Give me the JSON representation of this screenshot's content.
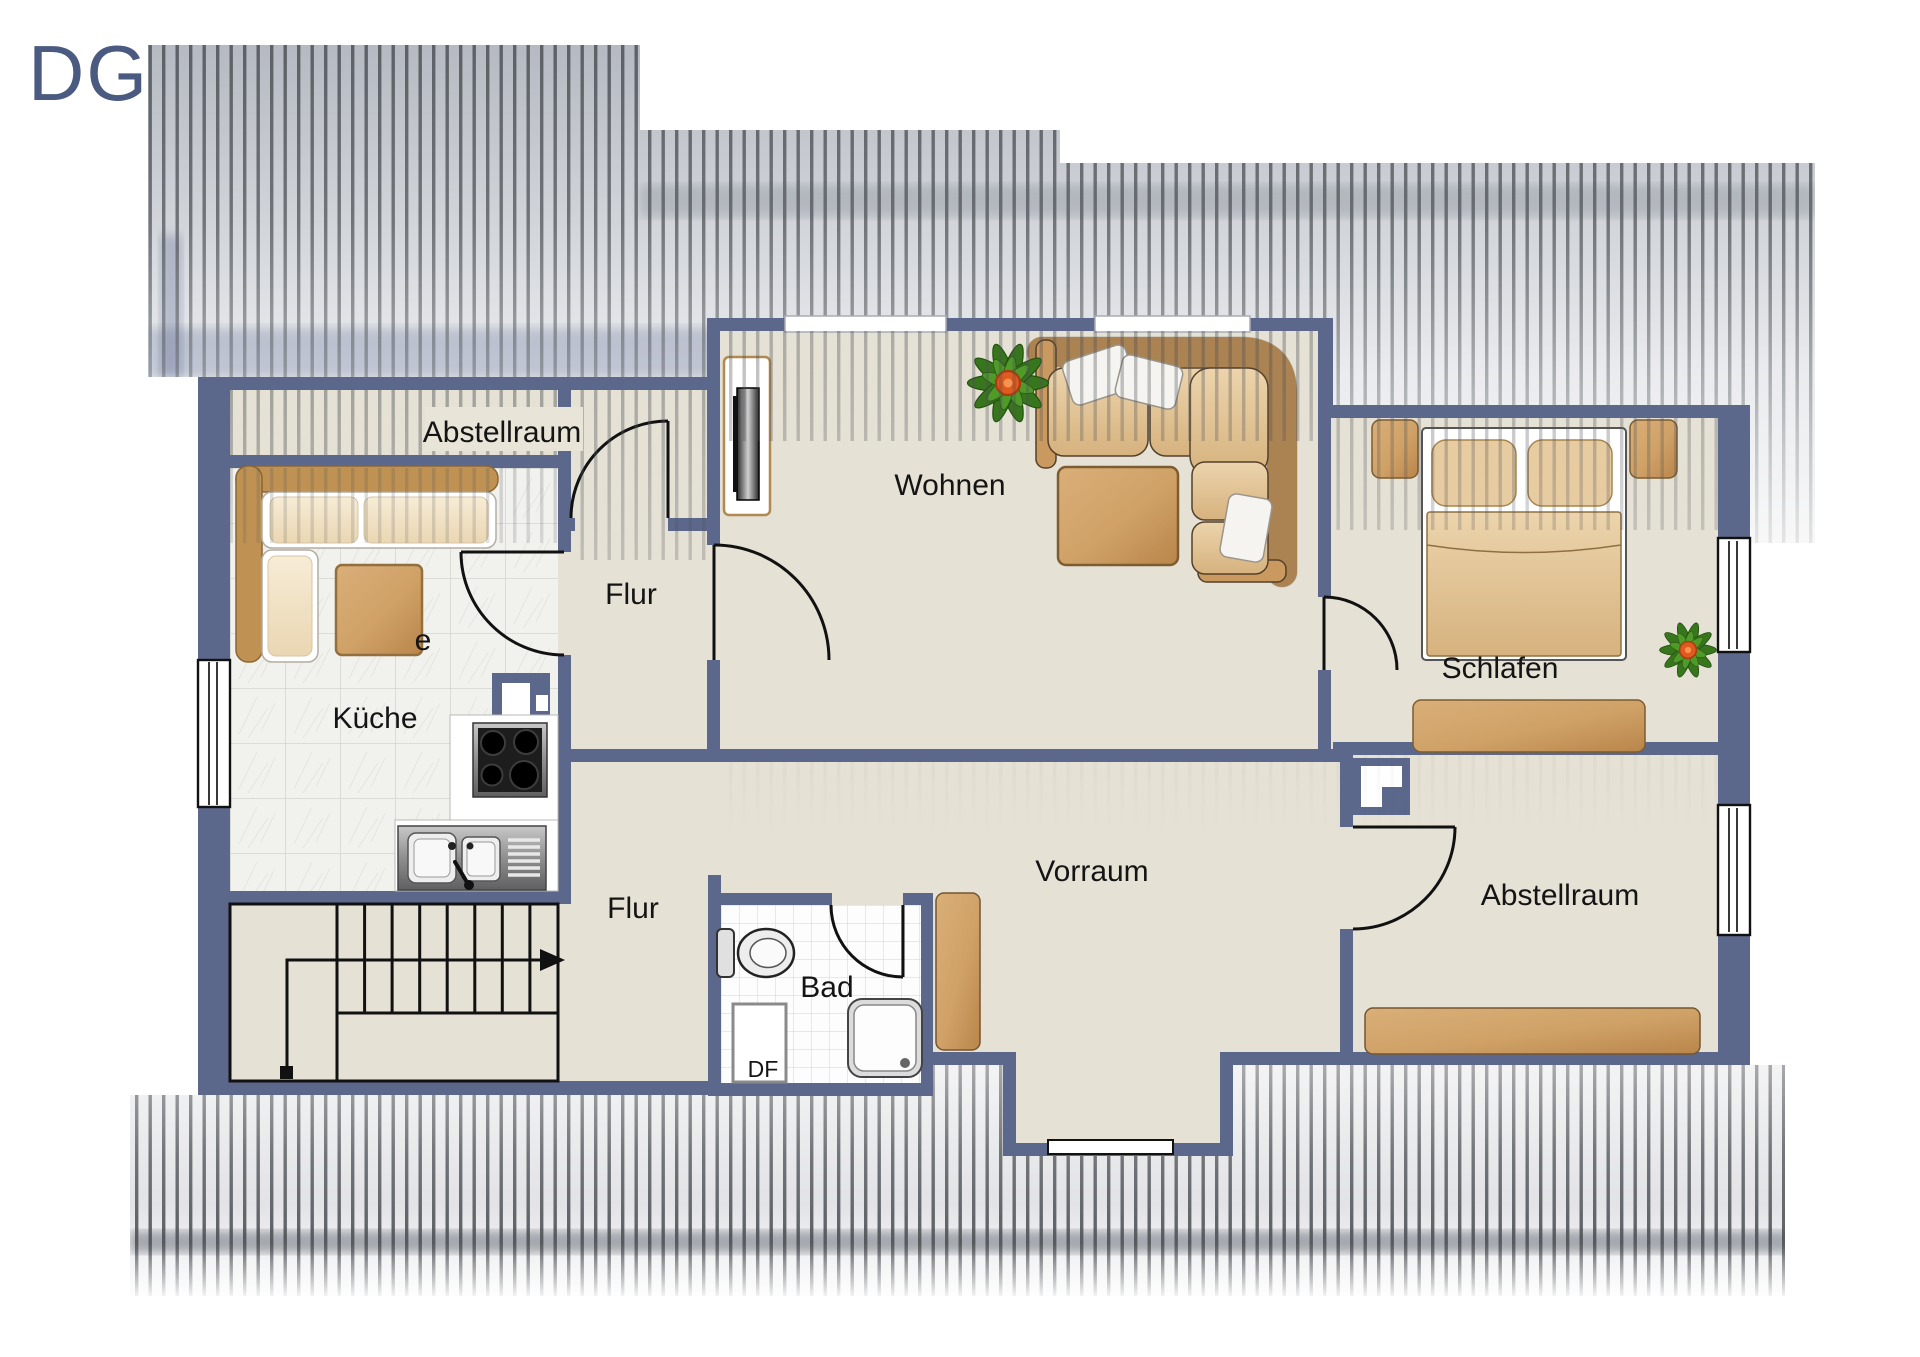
{
  "plan": {
    "floor_label": "DG",
    "type_note": "attic floor plan"
  },
  "rooms": {
    "abstellraum_top": {
      "label": "Abstellraum"
    },
    "kueche": {
      "label": "Küche"
    },
    "flur_upper": {
      "label": "Flur"
    },
    "wohnen": {
      "label": "Wohnen"
    },
    "schlafen": {
      "label": "Schlafen"
    },
    "vorraum": {
      "label": "Vorraum"
    },
    "flur_lower": {
      "label": "Flur"
    },
    "bad": {
      "label": "Bad"
    },
    "abstellraum_bottom": {
      "label": "Abstellraum"
    },
    "roof_window": {
      "label": "DF"
    },
    "partial_label": {
      "label": "e"
    }
  },
  "colors": {
    "wall": "#5b688c",
    "floor": "#e5e1d5",
    "roof_stripe": "#4e5256",
    "furniture_wood": "#c9995f",
    "label_text": "#141414",
    "floor_label_text": "#4b5a80"
  },
  "furniture": [
    "corner-bench",
    "kitchen-table",
    "stove",
    "kitchen-sink",
    "chimney",
    "tv-sideboard",
    "corner-sofa",
    "coffee-table",
    "plant",
    "double-bed",
    "nightstand",
    "dresser",
    "wardrobe",
    "toilet",
    "shower",
    "stairs",
    "sideboard"
  ]
}
